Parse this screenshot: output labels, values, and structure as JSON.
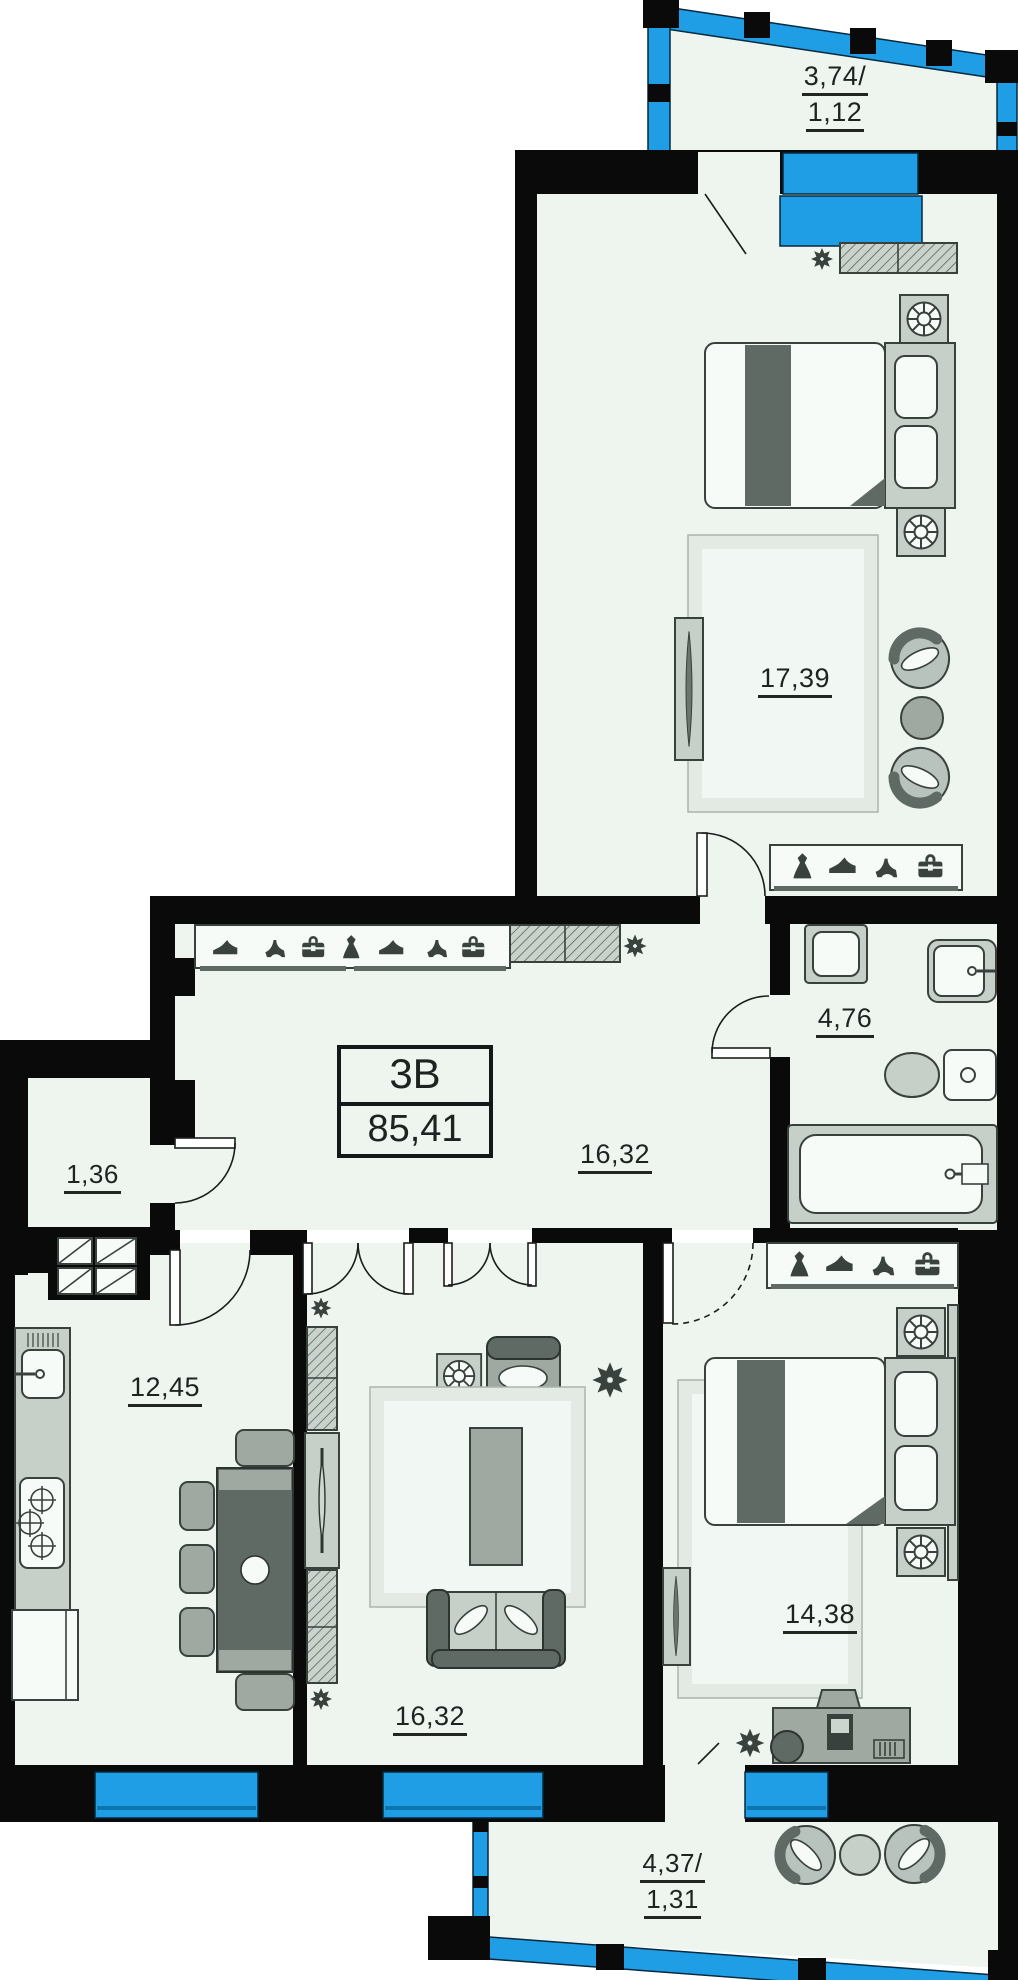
{
  "apartment": {
    "unit_label": "3B",
    "total_area": "85,41"
  },
  "rooms": {
    "balcony_top": {
      "line1": "3,74/",
      "line2": "1,12"
    },
    "bedroom_top": {
      "area": "17,39"
    },
    "bathroom": {
      "area": "4,76"
    },
    "hallway": {
      "area": "16,32"
    },
    "storage": {
      "area": "1,36"
    },
    "kitchen": {
      "area": "12,45"
    },
    "living_room": {
      "area": "16,32"
    },
    "bedroom_bottom": {
      "area": "14,38"
    },
    "balcony_bottom": {
      "line1": "4,37/",
      "line2": "1,31"
    }
  },
  "icons": {
    "radiator-icon": "eight-point star",
    "fan-icon": "ventilation fan in square",
    "wardrobe-icons": [
      "dress",
      "sneaker",
      "high-heel",
      "briefcase"
    ]
  },
  "colors": {
    "wall": "#0a0a0a",
    "glazing": "#1f9ee5",
    "glazing_dark": "#0f74ad",
    "floor": "#eef5ef",
    "furniture_light": "#c6cfc8",
    "furniture_mid": "#9fa9a2",
    "furniture_dark": "#5f6a64",
    "outline": "#39413d",
    "icon": "#3a423d",
    "text": "#1e2220"
  }
}
